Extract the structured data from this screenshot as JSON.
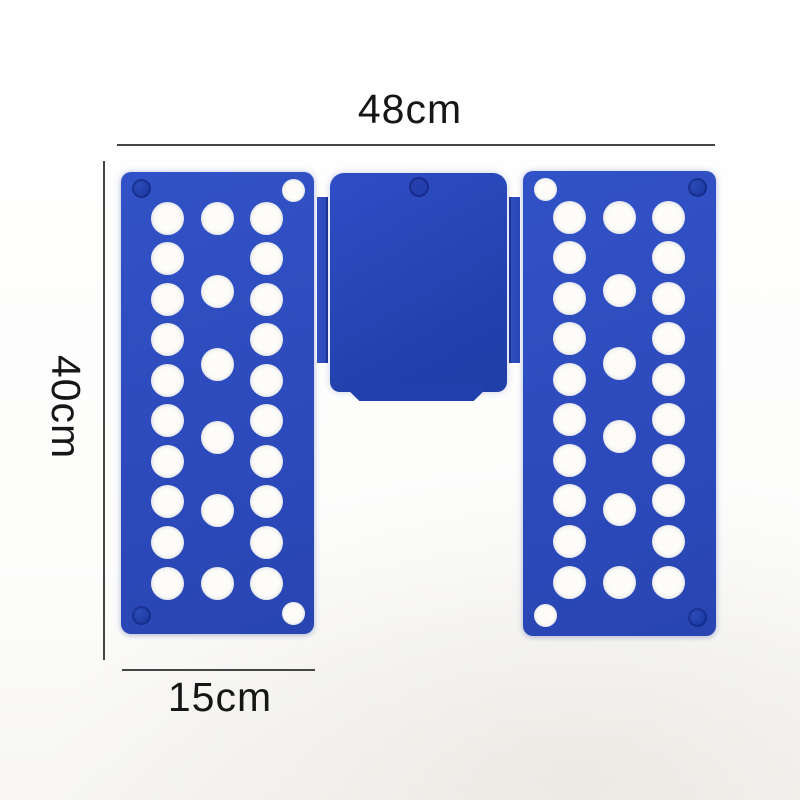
{
  "scene": {
    "description": "Blue plastic quick clothes-folding board (shirt folder) shown open, with size annotations",
    "background_color": "#fdfdfc"
  },
  "dimension_labels": {
    "total_width": "48cm",
    "total_height": "40cm",
    "side_panel_width": "15cm"
  },
  "colors": {
    "panel_blue": "#2e4cbe",
    "panel_blue_dark": "#2341ad",
    "hinge_blue": "#2a47b6",
    "rivet_blue": "#1b3aa0",
    "hole_white": "#fdfcf8",
    "dimension_line": "#454545",
    "label_text": "#161616"
  },
  "board": {
    "panel_count": 3,
    "hole_grid": {
      "columns_x": [
        46,
        96,
        145
      ],
      "top_y": 46,
      "bottom_y": 411,
      "outer_rows": 10,
      "middle_rows": 6,
      "hole_radius": 16.5
    }
  }
}
